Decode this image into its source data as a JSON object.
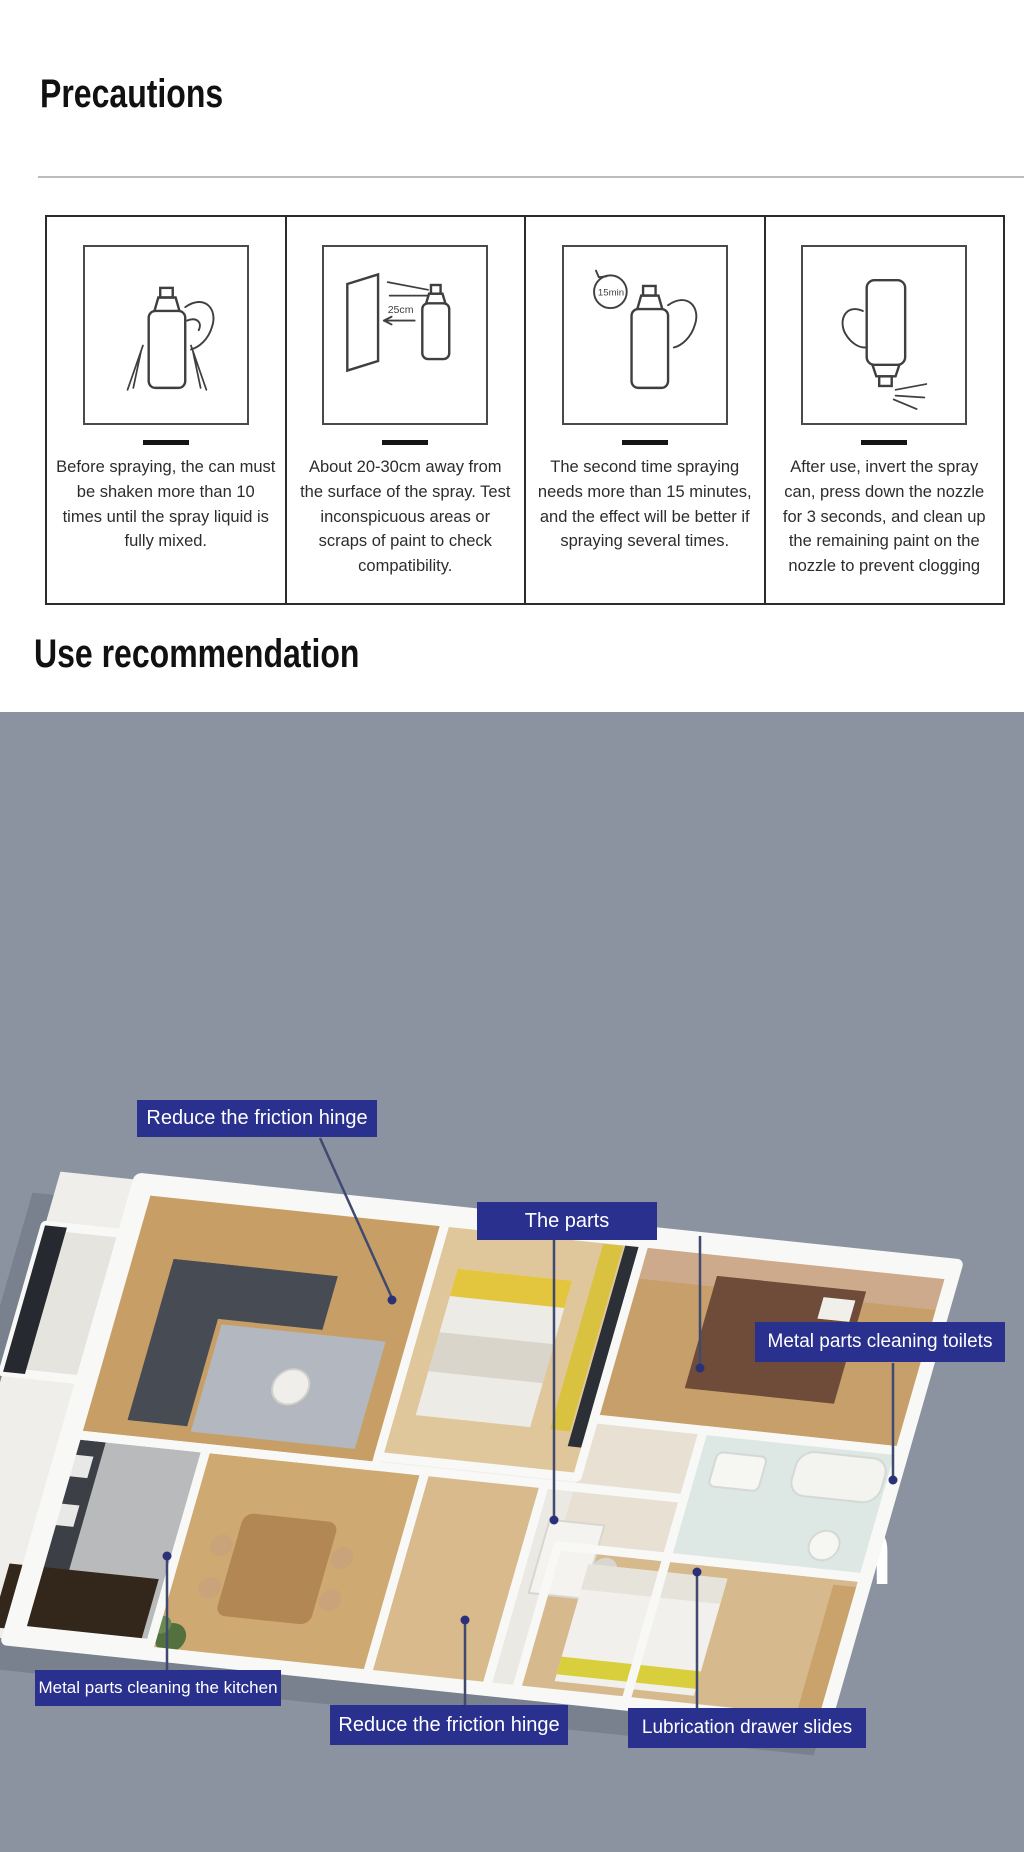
{
  "precautions": {
    "title": "Precautions",
    "steps": [
      {
        "icon": "spray-can-shake-icon",
        "text": "Before spraying, the can must be shaken more than 10 times until the spray liquid is fully mixed."
      },
      {
        "icon": "spray-distance-icon",
        "note": "25cm",
        "text": "About 20-30cm away from the surface of the spray. Test inconspicuous areas or scraps of paint to check compatibility."
      },
      {
        "icon": "spray-timer-icon",
        "note": "15min",
        "text": "The second time spraying needs more than 15 minutes, and the effect will be better if spraying several times."
      },
      {
        "icon": "spray-invert-icon",
        "text": "After use, invert the spray can, press down the nozzle for 3 seconds, and clean up the remaining paint on the nozzle to prevent clogging"
      }
    ]
  },
  "use_recommendation": {
    "title": "Use recommendation"
  },
  "family": {
    "title": "Family life application",
    "bg_color": "#8b93a0",
    "accent_color": "#29308e",
    "square_colors": [
      "#ffffff",
      "#2b2e8e",
      "#ffffff"
    ],
    "callouts": [
      {
        "label": "Reduce the friction hinge"
      },
      {
        "label": "The parts"
      },
      {
        "label": "Metal parts cleaning toilets"
      },
      {
        "label": "Metal parts cleaning the kitchen"
      },
      {
        "label": "Reduce the friction hinge"
      },
      {
        "label": "Lubrication drawer slides"
      }
    ]
  }
}
